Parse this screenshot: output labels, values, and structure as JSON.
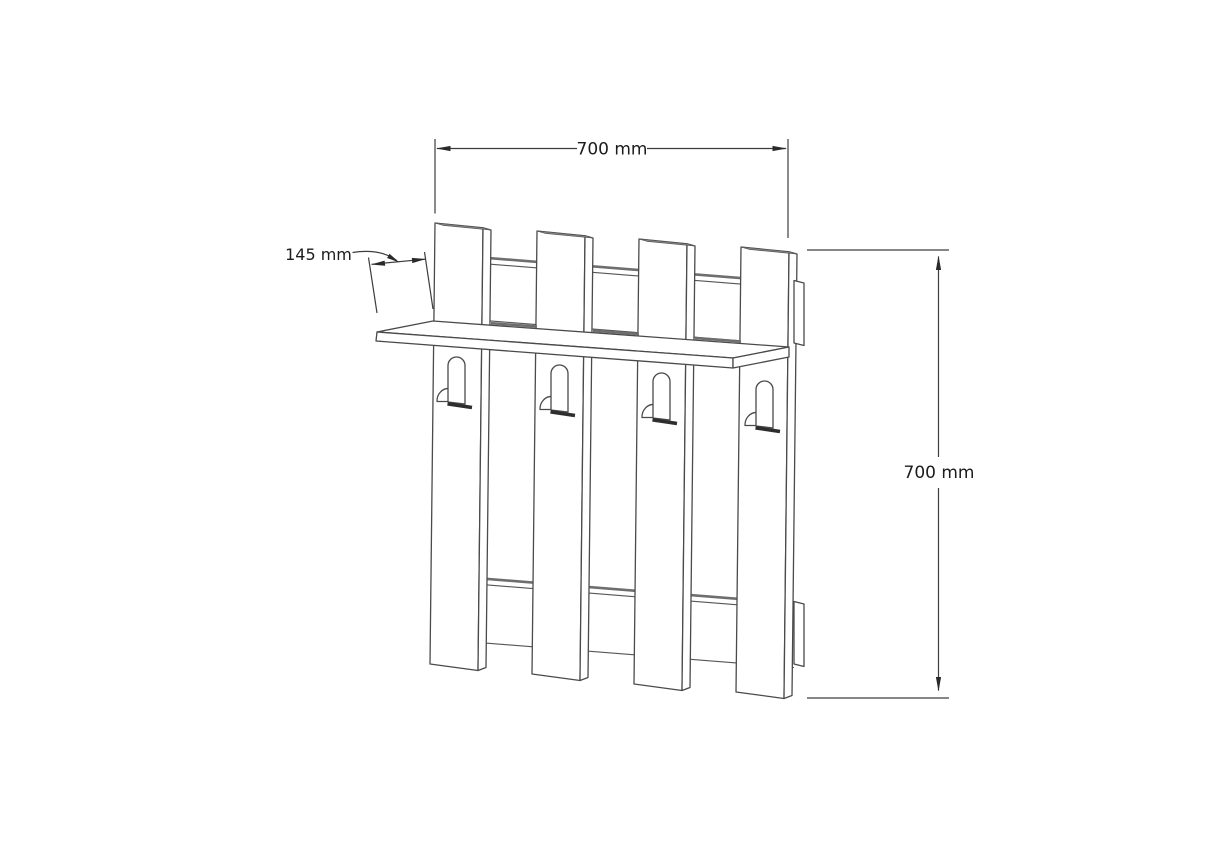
{
  "drawing": {
    "kind": "isometric line drawing of a wall-mounted coat rack with four slats, a shelf and four hooks",
    "dimensions": {
      "width": {
        "label": "700 mm"
      },
      "depth": {
        "label": "145 mm"
      },
      "height": {
        "label": "700 mm"
      }
    },
    "colors": {
      "background": "#ffffff",
      "line": "#4a4a4a",
      "shade": "#8f9396",
      "text": "#1c1c1c"
    }
  }
}
